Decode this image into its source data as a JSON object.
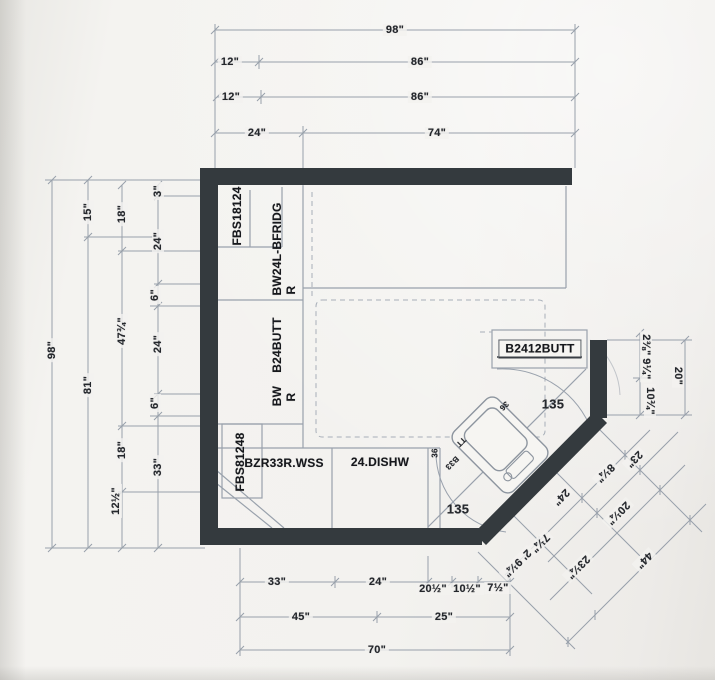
{
  "drawing": {
    "type": "kitchen-floor-plan",
    "corner_angle_deg": "135",
    "colors": {
      "wall": "#343a3e",
      "line": "#98a0ab",
      "paper": "#f3f2ef",
      "text": "#24272c"
    }
  },
  "labels": {
    "dims_top": [
      {
        "n": "dim-98-top",
        "t": "98\"",
        "x": 395,
        "y": 30,
        "r": 0
      },
      {
        "n": "dim-12-row2",
        "t": "12\"",
        "x": 230,
        "y": 62,
        "r": 0
      },
      {
        "n": "dim-86-row2",
        "t": "86\"",
        "x": 420,
        "y": 62,
        "r": 0
      },
      {
        "n": "dim-12-row3",
        "t": "12\"",
        "x": 231,
        "y": 97,
        "r": 0
      },
      {
        "n": "dim-86-row3",
        "t": "86\"",
        "x": 420,
        "y": 97,
        "r": 0
      },
      {
        "n": "dim-24-row4",
        "t": "24\"",
        "x": 257,
        "y": 133,
        "r": 0
      },
      {
        "n": "dim-74-row4",
        "t": "74\"",
        "x": 437,
        "y": 133,
        "r": 0
      }
    ],
    "dims_left": [
      {
        "n": "dim-98-left",
        "t": "98\"",
        "x": 52,
        "y": 350,
        "r": -90
      },
      {
        "n": "dim-15",
        "t": "15\"",
        "x": 88,
        "y": 212,
        "r": -90
      },
      {
        "n": "dim-81",
        "t": "81\"",
        "x": 88,
        "y": 385,
        "r": -90
      },
      {
        "n": "dim-18-a",
        "t": "18\"",
        "x": 122,
        "y": 214,
        "r": -90
      },
      {
        "n": "dim-47-75",
        "t": "47¾\"",
        "x": 122,
        "y": 331,
        "r": -90
      },
      {
        "n": "dim-18-b",
        "t": "18\"",
        "x": 122,
        "y": 450,
        "r": -90
      },
      {
        "n": "dim-12-5",
        "t": "12½\"",
        "x": 116,
        "y": 501,
        "r": -90
      },
      {
        "n": "dim-3",
        "t": "3\"",
        "x": 158,
        "y": 191,
        "r": -90
      },
      {
        "n": "dim-24-a",
        "t": "24\"",
        "x": 158,
        "y": 241,
        "r": -90
      },
      {
        "n": "dim-6-a",
        "t": "6\"",
        "x": 155,
        "y": 295,
        "r": -90
      },
      {
        "n": "dim-24-b",
        "t": "24\"",
        "x": 158,
        "y": 344,
        "r": -90
      },
      {
        "n": "dim-6-b",
        "t": "6\"",
        "x": 155,
        "y": 403,
        "r": -90
      },
      {
        "n": "dim-33-left",
        "t": "33\"",
        "x": 158,
        "y": 467,
        "r": -90
      }
    ],
    "dims_bottom": [
      {
        "n": "dim-33-bot",
        "t": "33\"",
        "x": 277,
        "y": 582,
        "r": 0
      },
      {
        "n": "dim-24-bot",
        "t": "24\"",
        "x": 378,
        "y": 582,
        "r": 0
      },
      {
        "n": "dim-20-5",
        "t": "20½\"",
        "x": 433,
        "y": 589,
        "r": 0
      },
      {
        "n": "dim-10-5",
        "t": "10½\"",
        "x": 467,
        "y": 589,
        "r": 0
      },
      {
        "n": "dim-7-5",
        "t": "7½\"",
        "x": 498,
        "y": 588,
        "r": 0
      },
      {
        "n": "dim-45",
        "t": "45\"",
        "x": 301,
        "y": 617,
        "r": 0
      },
      {
        "n": "dim-25",
        "t": "25\"",
        "x": 444,
        "y": 617,
        "r": 0
      },
      {
        "n": "dim-70",
        "t": "70\"",
        "x": 377,
        "y": 650,
        "r": 0
      }
    ],
    "dims_right": [
      {
        "n": "dim-2-38",
        "t": "2⅜\"",
        "x": 646,
        "y": 345,
        "r": 90
      },
      {
        "n": "dim-9-25",
        "t": "9¼\"",
        "x": 646,
        "y": 369,
        "r": 90
      },
      {
        "n": "dim-10-75",
        "t": "10¾\"",
        "x": 650,
        "y": 401,
        "r": 90
      },
      {
        "n": "dim-20",
        "t": "20\"",
        "x": 678,
        "y": 376,
        "r": 90
      }
    ],
    "dims_diagonal": [
      {
        "n": "dim-23-diag",
        "t": "23\"",
        "x": 634,
        "y": 459,
        "r": 135
      },
      {
        "n": "dim-8-25",
        "t": "8¼\"",
        "x": 605,
        "y": 473,
        "r": 135
      },
      {
        "n": "dim-24-diag",
        "t": "24\"",
        "x": 561,
        "y": 497,
        "r": 135
      },
      {
        "n": "dim-20-25",
        "t": "20¼\"",
        "x": 618,
        "y": 513,
        "r": 135
      },
      {
        "n": "dim-7-25",
        "t": "7¼\"",
        "x": 540,
        "y": 543,
        "r": 135
      },
      {
        "n": "dim-2ft-9-25",
        "t": "2' 9¼\"",
        "x": 517,
        "y": 563,
        "r": 135
      },
      {
        "n": "dim-23-25",
        "t": "23¼\"",
        "x": 578,
        "y": 567,
        "r": 135
      },
      {
        "n": "dim-44",
        "t": "44\"",
        "x": 644,
        "y": 560,
        "r": 135
      }
    ],
    "cabinets": [
      {
        "n": "cab-fbs18124",
        "t": "FBS18124",
        "x": 237,
        "y": 216,
        "r": -90
      },
      {
        "n": "cab-bw24l-bfridg",
        "t": "BW24L-BFRIDG",
        "x": 277,
        "y": 249,
        "r": -90
      },
      {
        "n": "cab-hinge-r-1",
        "t": "R",
        "x": 291,
        "y": 290,
        "r": -90
      },
      {
        "n": "cab-b24butt",
        "t": "B24BUTT",
        "x": 277,
        "y": 345,
        "r": -90
      },
      {
        "n": "cab-bw",
        "t": "BW",
        "x": 277,
        "y": 396,
        "r": -90
      },
      {
        "n": "cab-hinge-r-2",
        "t": "R",
        "x": 291,
        "y": 397,
        "r": -90
      },
      {
        "n": "cab-fbs81248",
        "t": "FBS81248",
        "x": 240,
        "y": 462,
        "r": -90
      },
      {
        "n": "cab-bzr33r-wss",
        "t": "BZR33R.WSS",
        "x": 284,
        "y": 463,
        "r": 0
      },
      {
        "n": "cab-24-dishw",
        "t": "24.DISHW",
        "x": 380,
        "y": 462,
        "r": 0
      }
    ],
    "cabinet_boxed": [
      {
        "n": "cab-b2412butt",
        "t": "B2412BUTT",
        "x": 540,
        "y": 349,
        "r": 0
      }
    ],
    "angles": [
      {
        "n": "angle-135-upper",
        "t": "135",
        "x": 553,
        "y": 404,
        "r": 0
      },
      {
        "n": "angle-135-lower",
        "t": "135",
        "x": 458,
        "y": 509,
        "r": 0
      }
    ],
    "small_marks": [
      {
        "n": "mark-36-sink",
        "t": "36",
        "x": 504,
        "y": 406,
        "r": 135
      },
      {
        "n": "mark-tt",
        "t": "TT",
        "x": 461,
        "y": 442,
        "r": 135
      },
      {
        "n": "mark-b33",
        "t": "B33",
        "x": 452,
        "y": 463,
        "r": 135
      },
      {
        "n": "mark-36-filler",
        "t": "36",
        "x": 435,
        "y": 453,
        "r": -90
      }
    ]
  }
}
